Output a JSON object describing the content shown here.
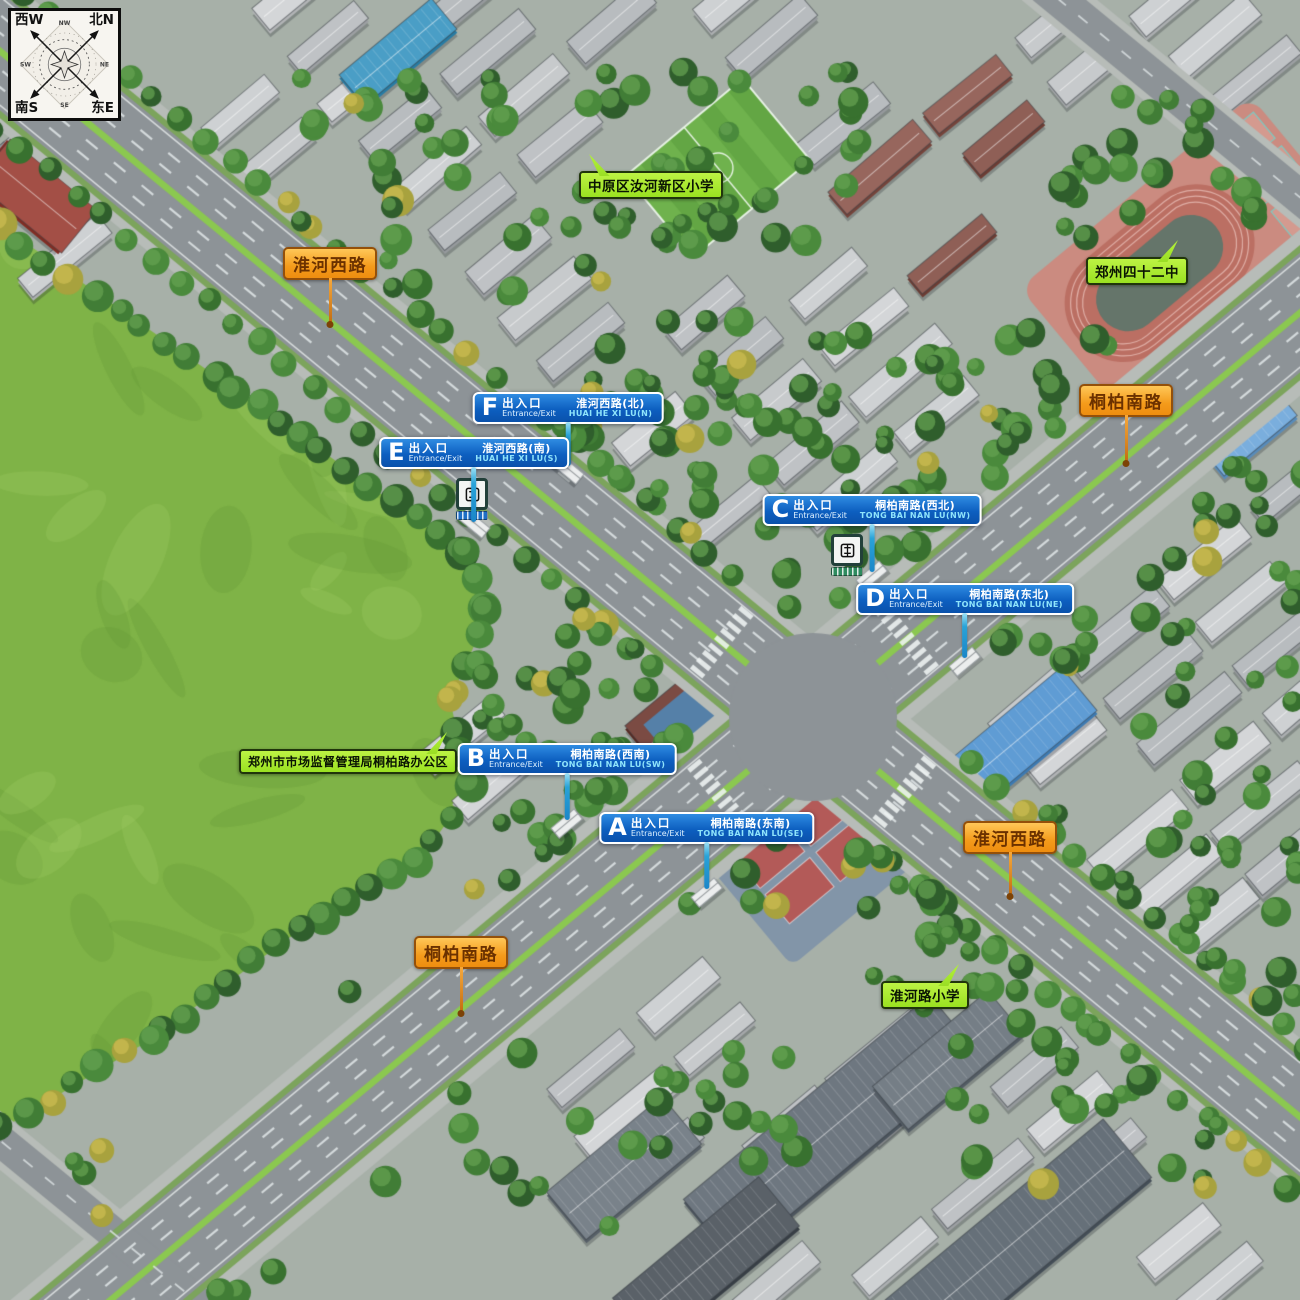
{
  "compass": {
    "tl": "西W",
    "tr": "北N",
    "bl": "南S",
    "br": "东E",
    "minor_top": "NW",
    "minor_right": "NE",
    "minor_bottom": "SE",
    "minor_left": "SW"
  },
  "road_labels": [
    {
      "text": "淮河西路",
      "x": 330,
      "y": 247,
      "stem": 47
    },
    {
      "text": "桐柏南路",
      "x": 1126,
      "y": 384,
      "stem": 49
    },
    {
      "text": "淮河西路",
      "x": 1010,
      "y": 821,
      "stem": 45
    },
    {
      "text": "桐柏南路",
      "x": 461,
      "y": 936,
      "stem": 47
    }
  ],
  "poi_labels": [
    {
      "text": "中原区汝河新区小学",
      "x": 651,
      "y": 171,
      "tail": "up-left",
      "size": 13.5
    },
    {
      "text": "郑州四十二中",
      "x": 1137,
      "y": 257,
      "tail": "up-right",
      "size": 13.5
    },
    {
      "text": "郑州市市场监督管理局桐柏路办公区",
      "x": 348,
      "y": 749,
      "tail": "up-right",
      "size": 12
    },
    {
      "text": "淮河路小学",
      "x": 925,
      "y": 981,
      "tail": "up-right",
      "size": 13.5
    }
  ],
  "exits": [
    {
      "letter": "F",
      "label_cn": "出入口",
      "label_en": "Entrance/Exit",
      "road_cn": "淮河西路(北)",
      "road_en": "HUAI HE XI LU(N)",
      "x": 568,
      "y": 392,
      "stem": 44
    },
    {
      "letter": "E",
      "label_cn": "出入口",
      "label_en": "Entrance/Exit",
      "road_cn": "淮河西路(南)",
      "road_en": "HUAI HE XI LU(S)",
      "x": 474,
      "y": 437,
      "stem": 55
    },
    {
      "letter": "C",
      "label_cn": "出入口",
      "label_en": "Entrance/Exit",
      "road_cn": "桐柏南路(西北)",
      "road_en": "TONG BAI NAN LU(NW)",
      "x": 872,
      "y": 494,
      "stem": 48
    },
    {
      "letter": "D",
      "label_cn": "出入口",
      "label_en": "Entrance/Exit",
      "road_cn": "桐柏南路(东北)",
      "road_en": "TONG BAI NAN LU(NE)",
      "x": 965,
      "y": 583,
      "stem": 45
    },
    {
      "letter": "B",
      "label_cn": "出入口",
      "label_en": "Entrance/Exit",
      "road_cn": "桐柏南路(西南)",
      "road_en": "TONG BAI NAN LU(SW)",
      "x": 567,
      "y": 743,
      "stem": 47
    },
    {
      "letter": "A",
      "label_cn": "出入口",
      "label_en": "Entrance/Exit",
      "road_cn": "桐柏南路(东南)",
      "road_en": "TONG BAI NAN LU(SE)",
      "x": 707,
      "y": 812,
      "stem": 47
    }
  ],
  "metro_signs": [
    {
      "x": 472,
      "y": 478,
      "band": "#1e6fc6"
    },
    {
      "x": 847,
      "y": 534,
      "band": "#2e8b5f"
    }
  ],
  "colors": {
    "exit_blue": "#0d5fc0",
    "road_label_orange": "#f49b1b",
    "poi_green": "#a4e92c",
    "stem_cyan": "#2aa8d8",
    "road_asphalt": "#8d9397",
    "grass": "#7fb347",
    "tree": "#3a7031"
  }
}
